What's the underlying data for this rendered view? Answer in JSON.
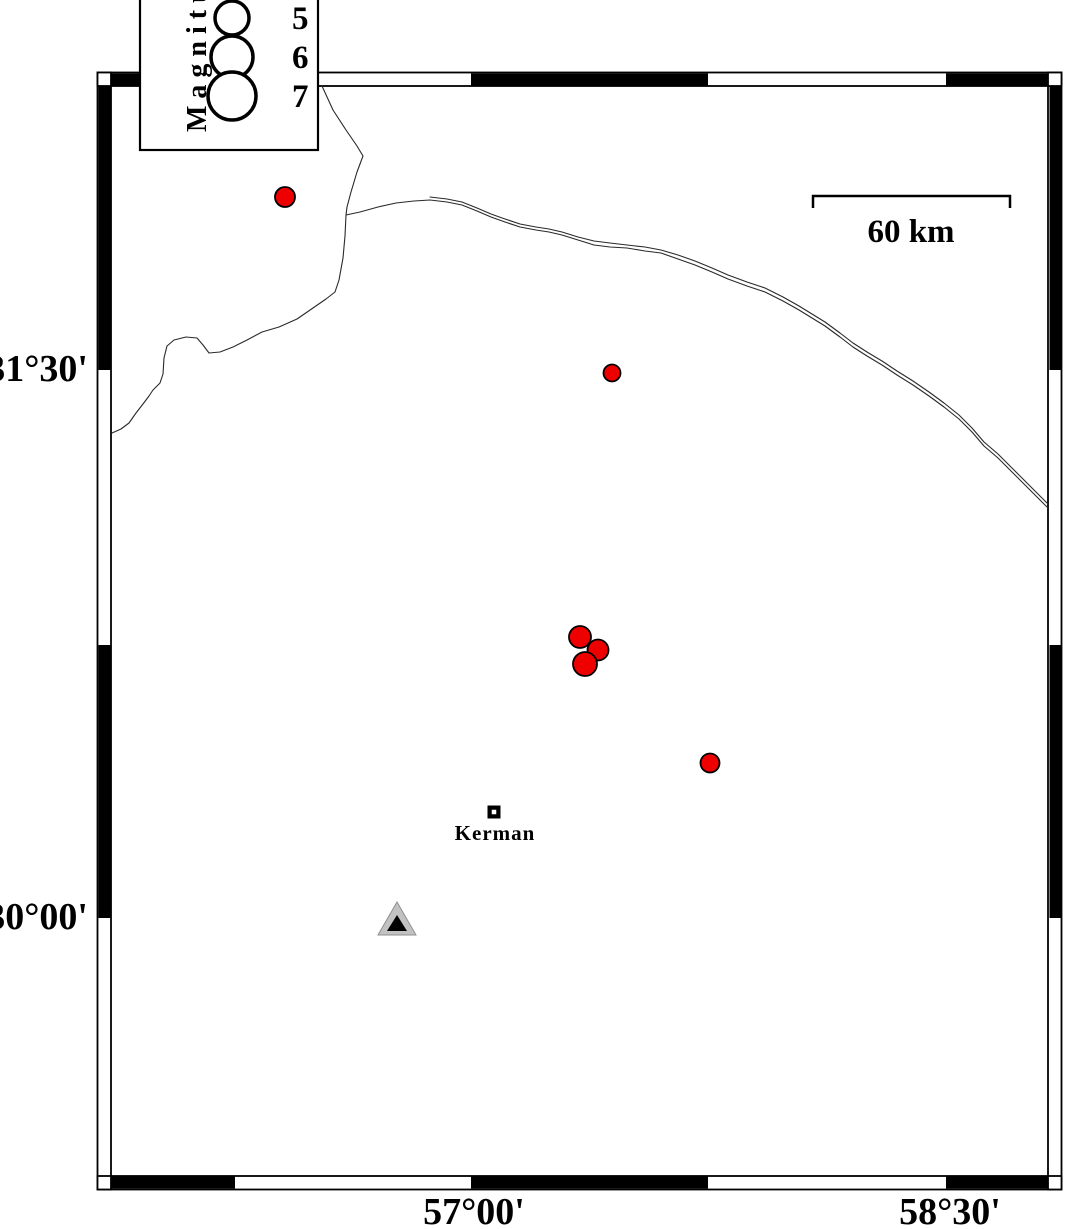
{
  "canvas": {
    "width": 1066,
    "height": 1229,
    "background": "#ffffff"
  },
  "frame": {
    "ink": "#000000",
    "outer_rect": {
      "x": 97.5,
      "y": 72.5,
      "w": 964,
      "h": 1117
    },
    "inner_rect": {
      "x": 111,
      "y": 86,
      "w": 937,
      "h": 1090
    },
    "corner_squares": [
      {
        "x": 97.5,
        "y": 72.5,
        "w": 13.5,
        "h": 13.5
      },
      {
        "x": 1048,
        "y": 72.5,
        "w": 13.5,
        "h": 13.5
      },
      {
        "x": 97.5,
        "y": 1176,
        "w": 13.5,
        "h": 13.5
      },
      {
        "x": 1048,
        "y": 1176,
        "w": 13.5,
        "h": 13.5
      }
    ],
    "black_segments": [
      {
        "x": 111,
        "y": 73.5,
        "w": 124,
        "h": 12
      },
      {
        "x": 471,
        "y": 73.5,
        "w": 237,
        "h": 12
      },
      {
        "x": 946,
        "y": 73.5,
        "w": 102,
        "h": 12
      },
      {
        "x": 111,
        "y": 1176.5,
        "w": 124,
        "h": 12
      },
      {
        "x": 471,
        "y": 1176.5,
        "w": 237,
        "h": 12
      },
      {
        "x": 946,
        "y": 1176.5,
        "w": 102,
        "h": 12
      },
      {
        "x": 98.5,
        "y": 86,
        "w": 12,
        "h": 284
      },
      {
        "x": 98.5,
        "y": 645,
        "w": 12,
        "h": 273
      },
      {
        "x": 1049.5,
        "y": 86,
        "w": 12,
        "h": 284
      },
      {
        "x": 1049.5,
        "y": 645,
        "w": 12,
        "h": 273
      }
    ]
  },
  "axis": {
    "lat_labels": [
      {
        "text": "31°30'",
        "x": 88,
        "y": 381
      },
      {
        "text": "30°00'",
        "x": 88,
        "y": 929
      }
    ],
    "lon_labels": [
      {
        "text": "57°00'",
        "x": 474,
        "y": 1224
      },
      {
        "text": "58°30'",
        "x": 950,
        "y": 1224
      }
    ]
  },
  "legend": {
    "title": "Magnitude",
    "visible_title": "Magnit",
    "box": {
      "x": 140,
      "y": -42,
      "w": 178,
      "h": 192
    },
    "title_pos": {
      "x": 206,
      "y": 132
    },
    "circle_stroke_width": 3.5,
    "circles": [
      {
        "label": "5",
        "cx": 232,
        "cy": 18,
        "r": 17
      },
      {
        "label": "6",
        "cx": 232,
        "cy": 57,
        "r": 21
      },
      {
        "label": "7",
        "cx": 232,
        "cy": 96,
        "r": 24
      }
    ],
    "label_x": 292
  },
  "scale_bar": {
    "label": "60 km",
    "x1": 813,
    "x2": 1010,
    "y": 196,
    "tick_drop": 12,
    "label_x": 911,
    "label_y": 242
  },
  "city": {
    "name": "Kerman",
    "marker": {
      "cx": 494,
      "cy": 812,
      "outer": 13,
      "inner": 4.5
    },
    "label_pos": {
      "x": 495,
      "y": 840
    }
  },
  "station": {
    "outer_triangle": {
      "points": [
        [
          397,
          902
        ],
        [
          378,
          935
        ],
        [
          416,
          935
        ]
      ],
      "fill": "#c2c2c2",
      "stroke": "#8f8f8f"
    },
    "inner_triangle": {
      "points": [
        [
          397,
          915
        ],
        [
          387,
          931
        ],
        [
          407,
          931
        ]
      ],
      "fill": "#000000"
    }
  },
  "earthquakes": {
    "fill": "#ee0000",
    "stroke": "#000000",
    "stroke_width": 1.8,
    "points": [
      {
        "x": 285,
        "y": 197,
        "r": 10,
        "approx_lon": "56.41E",
        "approx_lat": "31.97N"
      },
      {
        "x": 612,
        "y": 373,
        "r": 8.5,
        "approx_lon": "57.45E",
        "approx_lat": "31.49N"
      },
      {
        "x": 598,
        "y": 650,
        "r": 10.5,
        "approx_lon": "57.40E",
        "approx_lat": "30.73N"
      },
      {
        "x": 580,
        "y": 637,
        "r": 11,
        "approx_lon": "57.34E",
        "approx_lat": "30.77N"
      },
      {
        "x": 585,
        "y": 664,
        "r": 12,
        "approx_lon": "57.36E",
        "approx_lat": "30.70N"
      },
      {
        "x": 710,
        "y": 763,
        "r": 9.5,
        "approx_lon": "57.75E",
        "approx_lat": "30.42N"
      }
    ]
  },
  "boundaries": {
    "color": "#2a2a2a",
    "width": 1.1,
    "paths": [
      {
        "name": "boundary-west",
        "points": [
          [
            322,
            86
          ],
          [
            333,
            110
          ],
          [
            346,
            130
          ],
          [
            357,
            146
          ],
          [
            363,
            156
          ],
          [
            357,
            172
          ],
          [
            351,
            192
          ],
          [
            347,
            207
          ],
          [
            346,
            215
          ],
          [
            345,
            236
          ],
          [
            343,
            258
          ],
          [
            339,
            280
          ],
          [
            335,
            292
          ],
          [
            326,
            299
          ],
          [
            313,
            308
          ],
          [
            297,
            319
          ],
          [
            279,
            327
          ],
          [
            262,
            332
          ],
          [
            247,
            340
          ],
          [
            233,
            347
          ],
          [
            220,
            352
          ],
          [
            209,
            353
          ],
          [
            203,
            345
          ],
          [
            197,
            338
          ],
          [
            186,
            337
          ],
          [
            174,
            340
          ],
          [
            167,
            346
          ],
          [
            164,
            358
          ],
          [
            163,
            374
          ],
          [
            160,
            383
          ],
          [
            153,
            390
          ],
          [
            149,
            396
          ],
          [
            143,
            404
          ],
          [
            136,
            413
          ],
          [
            129,
            423
          ],
          [
            121,
            429
          ],
          [
            112,
            433
          ]
        ]
      },
      {
        "name": "boundary-east-a",
        "points": [
          [
            346,
            215
          ],
          [
            360,
            212
          ],
          [
            378,
            207
          ],
          [
            396,
            203
          ],
          [
            414,
            201
          ],
          [
            430,
            200
          ],
          [
            447,
            202
          ],
          [
            462,
            205
          ],
          [
            477,
            211
          ],
          [
            491,
            217
          ],
          [
            505,
            222
          ],
          [
            520,
            227
          ],
          [
            536,
            230
          ],
          [
            549,
            232
          ],
          [
            562,
            235
          ],
          [
            578,
            240
          ],
          [
            594,
            245
          ],
          [
            610,
            247
          ],
          [
            627,
            248
          ],
          [
            645,
            251
          ],
          [
            661,
            253
          ],
          [
            678,
            259
          ],
          [
            695,
            265
          ],
          [
            712,
            272
          ],
          [
            728,
            279
          ],
          [
            747,
            286
          ],
          [
            765,
            292
          ],
          [
            783,
            301
          ],
          [
            799,
            310
          ],
          [
            812,
            318
          ],
          [
            825,
            326
          ],
          [
            840,
            337
          ],
          [
            853,
            347
          ],
          [
            867,
            356
          ],
          [
            882,
            365
          ],
          [
            897,
            375
          ],
          [
            913,
            385
          ],
          [
            929,
            396
          ],
          [
            944,
            407
          ],
          [
            959,
            419
          ],
          [
            972,
            432
          ],
          [
            984,
            446
          ],
          [
            998,
            458
          ],
          [
            1013,
            473
          ],
          [
            1028,
            488
          ],
          [
            1040,
            500
          ],
          [
            1048,
            508
          ]
        ]
      },
      {
        "name": "boundary-east-b",
        "points": [
          [
            430,
            197
          ],
          [
            447,
            199
          ],
          [
            462,
            202
          ],
          [
            477,
            208
          ],
          [
            491,
            214
          ],
          [
            505,
            219
          ],
          [
            520,
            224
          ],
          [
            536,
            227
          ],
          [
            549,
            229
          ],
          [
            562,
            232
          ],
          [
            578,
            237
          ],
          [
            594,
            241
          ],
          [
            610,
            243
          ],
          [
            627,
            245
          ],
          [
            645,
            247
          ],
          [
            661,
            250
          ],
          [
            678,
            255
          ],
          [
            695,
            261
          ],
          [
            712,
            268
          ],
          [
            728,
            275
          ],
          [
            747,
            282
          ],
          [
            765,
            288
          ],
          [
            783,
            297
          ],
          [
            799,
            306
          ],
          [
            812,
            314
          ],
          [
            825,
            322
          ],
          [
            840,
            333
          ],
          [
            853,
            343
          ],
          [
            867,
            352
          ],
          [
            882,
            361
          ],
          [
            897,
            371
          ],
          [
            913,
            381
          ],
          [
            929,
            392
          ],
          [
            944,
            403
          ],
          [
            959,
            415
          ],
          [
            972,
            428
          ],
          [
            984,
            442
          ],
          [
            998,
            454
          ],
          [
            1013,
            469
          ],
          [
            1028,
            484
          ],
          [
            1040,
            496
          ],
          [
            1048,
            504
          ]
        ]
      }
    ]
  }
}
